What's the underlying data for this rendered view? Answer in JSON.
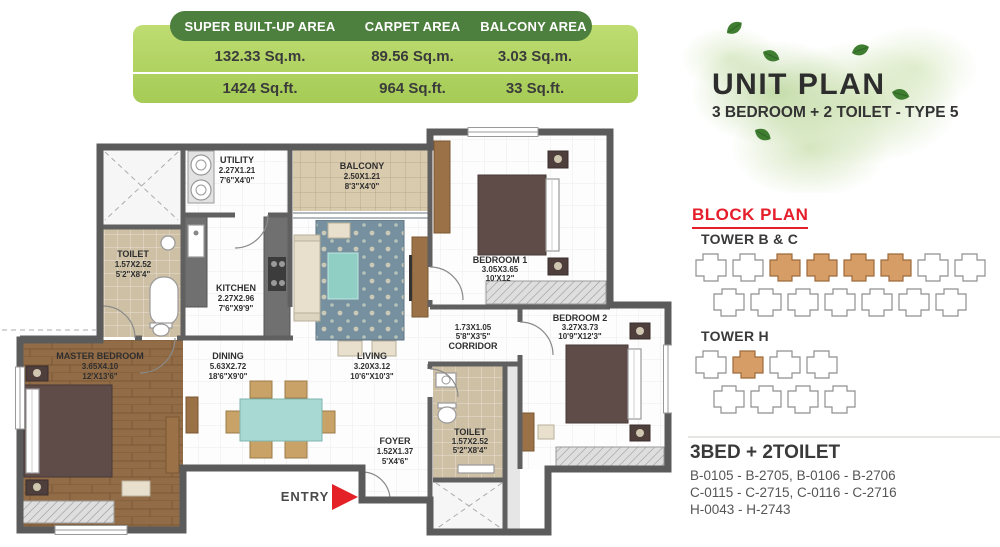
{
  "area_table": {
    "columns": [
      {
        "header": "SUPER BUILT-UP AREA",
        "sqm": "132.33 Sq.m.",
        "sqft": "1424 Sq.ft."
      },
      {
        "header": "CARPET AREA",
        "sqm": "89.56 Sq.m.",
        "sqft": "964 Sq.ft."
      },
      {
        "header": "BALCONY AREA",
        "sqm": "3.03 Sq.m.",
        "sqft": "33 Sq.ft."
      }
    ]
  },
  "title_block": {
    "title": "UNIT PLAN",
    "subtitle": "3 BEDROOM + 2 TOILET - TYPE 5"
  },
  "block_plan": {
    "heading": "BLOCK PLAN",
    "towers": [
      {
        "label": "TOWER B & C"
      },
      {
        "label": "TOWER H"
      }
    ]
  },
  "unit_listing": {
    "heading": "3BED + 2TOILET",
    "lines": [
      "B-0105 - B-2705, B-0106 - B-2706",
      "C-0115 - C-2715, C-0116 - C-2716",
      "H-0043 - H-2743"
    ]
  },
  "floorplan": {
    "entry_label": "ENTRY",
    "rooms": [
      {
        "name": "UTILITY",
        "m": "2.27X1.21",
        "ft": "7'6\"X4'0\""
      },
      {
        "name": "BALCONY",
        "m": "2.50X1.21",
        "ft": "8'3\"X4'0\""
      },
      {
        "name": "TOILET",
        "m": "1.57X2.52",
        "ft": "5'2\"X8'4\""
      },
      {
        "name": "KITCHEN",
        "m": "2.27X2.96",
        "ft": "7'6\"X9'9\""
      },
      {
        "name": "BEDROOM 1",
        "m": "3.05X3.65",
        "ft": "10'X12\""
      },
      {
        "name": "BEDROOM 2",
        "m": "3.27X3.73",
        "ft": "10'9\"X12'3\""
      },
      {
        "name": "MASTER BEDROOM",
        "m": "3.65X4.10",
        "ft": "12'X13'6\""
      },
      {
        "name": "DINING",
        "m": "5.63X2.72",
        "ft": "18'6\"X9'0\""
      },
      {
        "name": "LIVING",
        "m": "3.20X3.12",
        "ft": "10'6\"X10'3\""
      },
      {
        "name": "CORRIDOR",
        "m": "1.73X1.05",
        "ft": "5'8\"X3'5\""
      },
      {
        "name": "FOYER",
        "m": "1.52X1.37",
        "ft": "5'X4'6\""
      },
      {
        "name": "TOILET",
        "m": "1.57X2.52",
        "ft": "5'2\"X8'4\""
      }
    ]
  },
  "colors": {
    "brand_green_dark": "#4d7f3e",
    "brand_green_light": "#a5cb55",
    "heading_red": "#e51e2a",
    "highlight_tan": "#d69e66"
  }
}
